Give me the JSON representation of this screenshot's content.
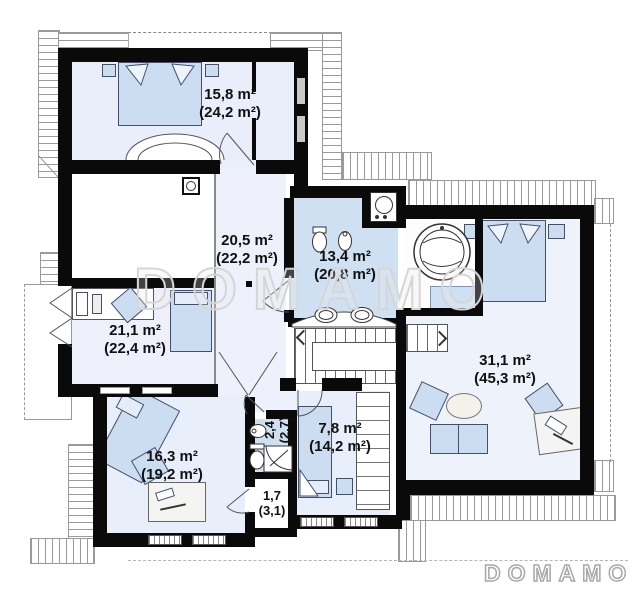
{
  "watermark": {
    "center": "DOMAMO",
    "corner": "DOMAMO"
  },
  "rooms": {
    "bedroom1": {
      "area": "15,8 m²",
      "total": "(24,2 m²)"
    },
    "hall": {
      "area": "20,5 m²",
      "total": "(22,2 m²)"
    },
    "bathroom": {
      "area": "13,4 m²",
      "total": "(20,8 m²)"
    },
    "bedroom2": {
      "area": "21,1 m²",
      "total": "(22,4 m²)"
    },
    "master": {
      "area": "31,1 m²",
      "total": "(45,3 m²)"
    },
    "bedroom3": {
      "area": "16,3 m²",
      "total": "(19,2 m²)"
    },
    "wc": {
      "area": "2,4",
      "total": "(2,7)"
    },
    "closet": {
      "area": "1,7",
      "total": "(3,1)"
    },
    "bedroom4": {
      "area": "7,8 m²",
      "total": "(14,2 m²)"
    }
  },
  "colors": {
    "wall": "#0a0a0a",
    "room_fill": "#e9eefa",
    "wet_room_fill": "#cfe0f2",
    "furniture_fill": "#ccddf1",
    "watermark": "#d6d6d6"
  }
}
